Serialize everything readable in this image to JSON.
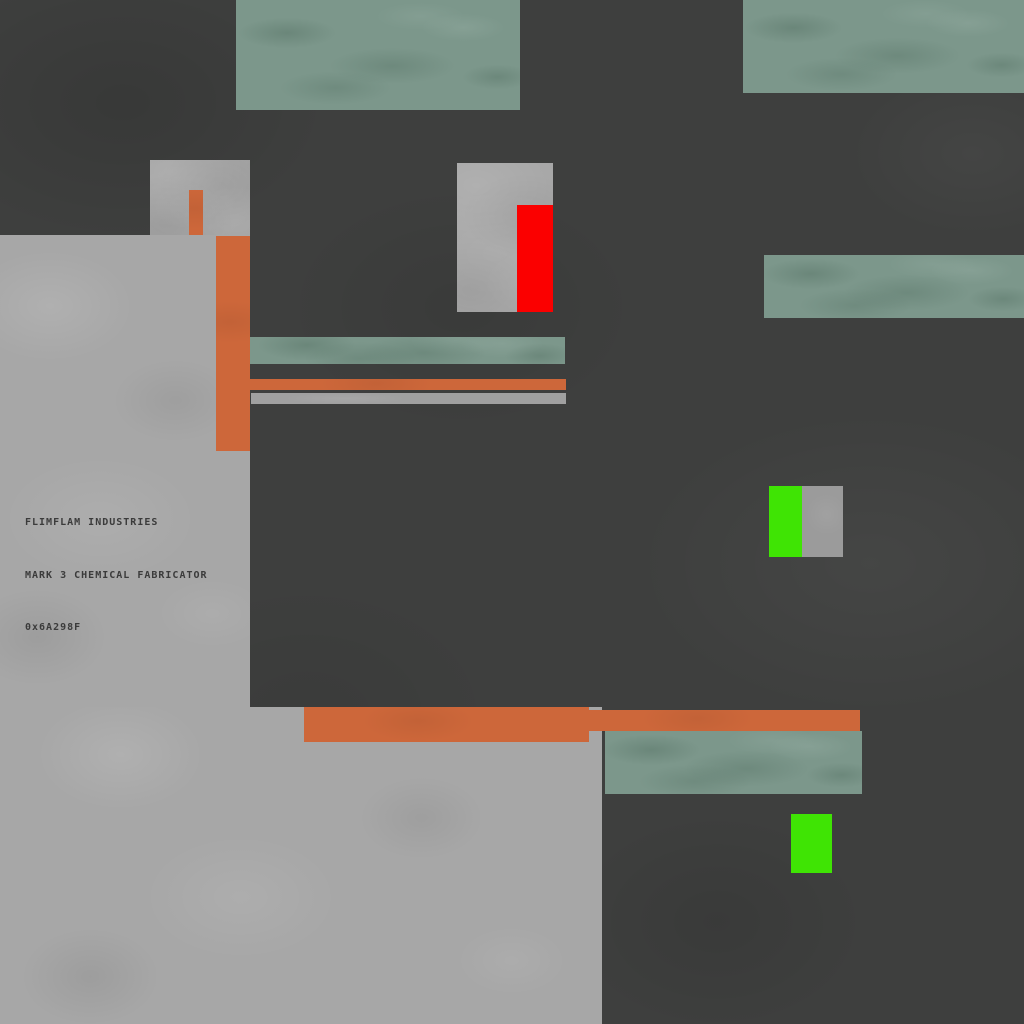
{
  "machine_label": {
    "line1": "FLIMFLAM INDUSTRIES",
    "line2": "MARK 3 CHEMICAL FABRICATOR",
    "line3": "0x6A298F"
  },
  "palette": {
    "background_dark": "#3e3f3e",
    "panel_gray": "#a7a7a7",
    "sage_green_duct": "#7c978b",
    "pipe_orange": "#cd673a",
    "status_red": "#fb0000",
    "indicator_lime": "#3fe404",
    "rail_gray": "#a0a0a0",
    "indicator_housing_gray": "#9b9b9b",
    "label_text": "#3b3b3b"
  }
}
